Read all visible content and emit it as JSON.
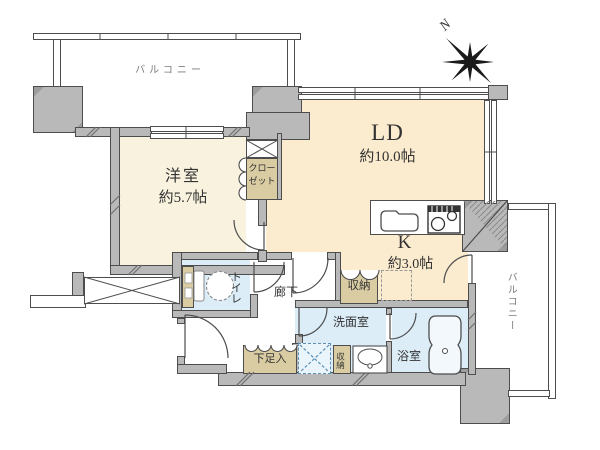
{
  "compass": {
    "label": "N"
  },
  "balcony_top": {
    "label": "バルコニー"
  },
  "balcony_right": {
    "label": "バルコニー"
  },
  "rooms": {
    "western": {
      "name": "洋室",
      "size": "約5.7帖"
    },
    "closet": {
      "line1": "クロー",
      "line2": "ゼット"
    },
    "living": {
      "name": "LD",
      "size": "約10.0帖"
    },
    "kitchen": {
      "name": "K",
      "size": "約3.0帖"
    },
    "hallway": {
      "label": "廊下"
    },
    "toilet": {
      "label": "トイレ"
    },
    "washroom": {
      "label": "洗面室"
    },
    "bathroom": {
      "label": "浴室"
    },
    "storage_k": {
      "label": "収納"
    },
    "storage_wash": {
      "label": "収納"
    },
    "shoe_cabinet": {
      "label": "下足入"
    }
  },
  "colors": {
    "wall_fill": "#b9b9b9",
    "wall_line": "#4d4d4d",
    "living_floor": "#fbeccf",
    "western_floor": "#f8f2de",
    "storage_tan": "#d9cca2",
    "water_blue": "#dcedf8",
    "balcony_label": "#7a7a7a",
    "dashed_blue": "#5b8fb5"
  }
}
